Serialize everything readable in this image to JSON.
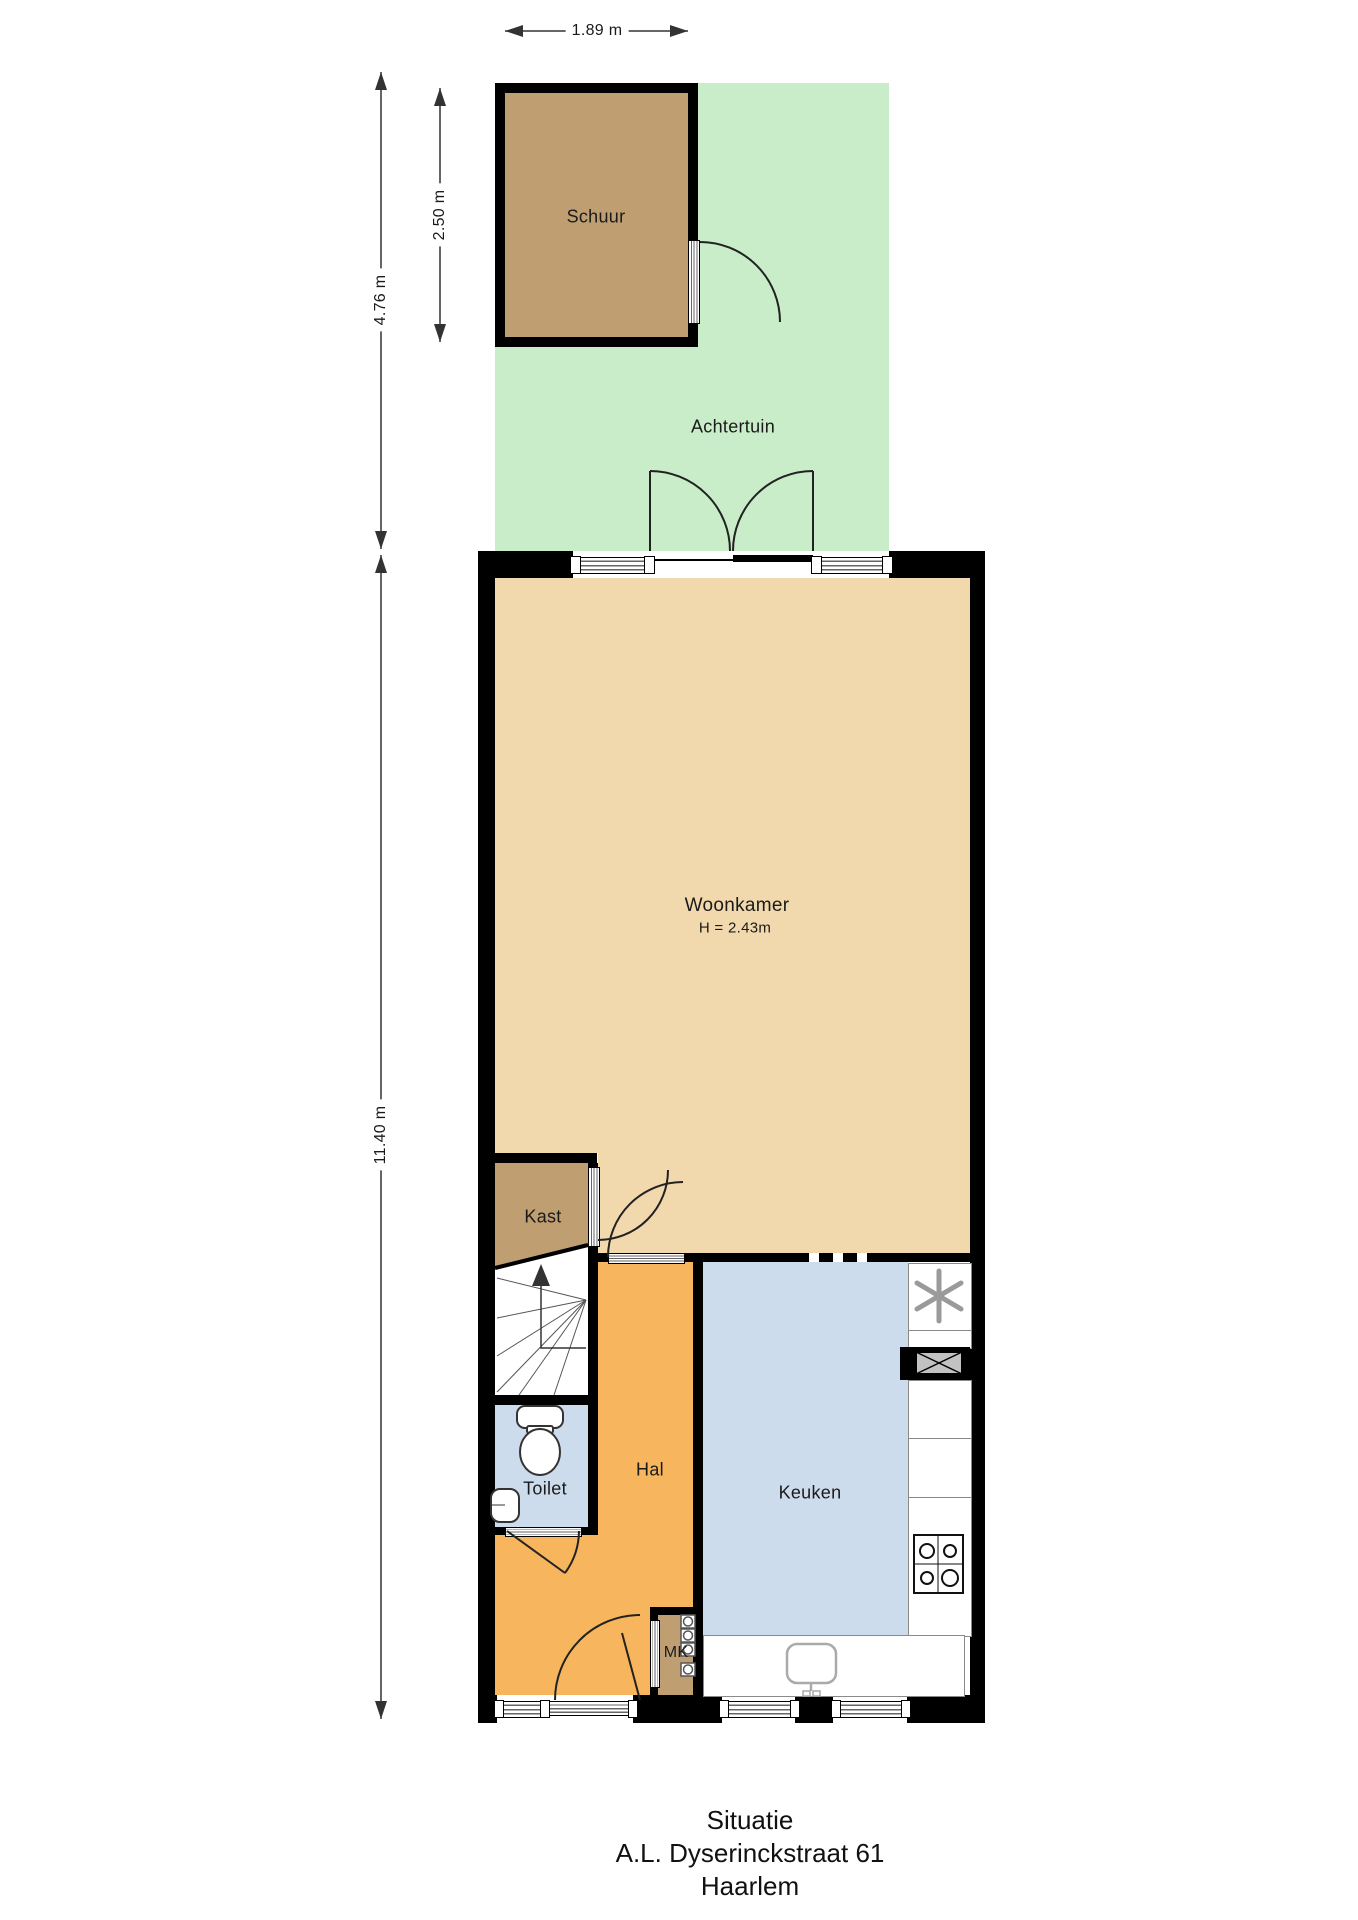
{
  "plan": {
    "rooms": {
      "schuur": "Schuur",
      "achtertuin": "Achtertuin",
      "woonkamer": "Woonkamer",
      "woonkamer_height": "H = 2.43m",
      "kast": "Kast",
      "toilet": "Toilet",
      "hal": "Hal",
      "keuken": "Keuken",
      "mk": "MK"
    },
    "dimensions": {
      "schuur_width": "1.89 m",
      "schuur_depth": "2.50 m",
      "achtertuin_depth": "4.76 m",
      "house_depth": "11.40 m"
    },
    "title": {
      "line1": "Situatie",
      "line2": "A.L. Dyserinckstraat 61",
      "line3": "Haarlem"
    },
    "colors": {
      "garden": "#c9ecc9",
      "shed_floor": "#bf9f72",
      "living_floor": "#f1d9ad",
      "hall_floor": "#f7b55d",
      "wet_room_floor": "#cddcec",
      "wall": "#000000"
    },
    "icons": [
      "ventilation-fan-icon",
      "duct-shaft-icon",
      "cooktop-icon",
      "kitchen-sink-icon",
      "toilet-icon",
      "hand-basin-icon",
      "stairs-up-arrow-icon",
      "meter-cabinet-icons"
    ]
  }
}
